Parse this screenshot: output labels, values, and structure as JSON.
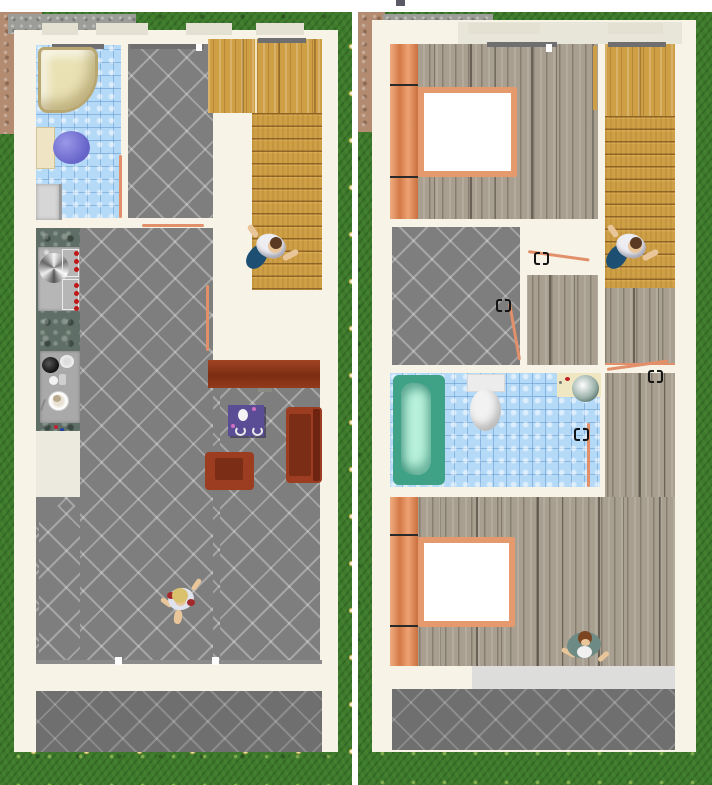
{
  "scene": {
    "type": "home-design-aerial-3d-view",
    "description": "Two top-down rendered views of the same house: ground floor (left) and upper floor (right), lawn with daisies around, dirt path and concrete walk at top-left of each view",
    "panels": [
      {
        "name": "ground-floor-view",
        "side": "left",
        "rooms": [
          {
            "name": "bathroom",
            "floor_texture": "blue-tile",
            "items": [
              "corner-shower",
              "toilet",
              "washing-machine"
            ]
          },
          {
            "name": "entry-hall",
            "floor_texture": "gray-diagonal-tile"
          },
          {
            "name": "staircase",
            "floor_texture": "golden-wood",
            "items": [
              "landing",
              "stair-treads"
            ]
          },
          {
            "name": "kitchen",
            "counter_texture": "green-stone",
            "items": [
              "sink-stove-unit-with-red-knobs",
              "prep-counter-with-pots-and-plates",
              "base-cabinet"
            ]
          },
          {
            "name": "living-room",
            "floor_texture": "gray-diagonal-tile",
            "items": [
              "sideboard-table",
              "purple-coffee-table",
              "armchair",
              "sofa"
            ]
          },
          {
            "name": "terrace",
            "floor_texture": "gray-diagonal-tile"
          }
        ],
        "open_doors": [
          "bathroom-door",
          "hall-to-living-door",
          "living-to-stairs-door"
        ]
      },
      {
        "name": "upper-floor-view",
        "side": "right",
        "rooms": [
          {
            "name": "bedroom-north",
            "floor_texture": "weathered-gray-wood",
            "items": [
              "wardrobe-row",
              "double-bed"
            ]
          },
          {
            "name": "staircase",
            "floor_texture": "golden-wood",
            "items": [
              "landing",
              "stair-treads"
            ]
          },
          {
            "name": "den",
            "floor_texture": "gray-diagonal-tile"
          },
          {
            "name": "hallway",
            "floor_texture": "weathered-gray-wood"
          },
          {
            "name": "bathroom",
            "floor_texture": "blue-tile",
            "items": [
              "bathtub",
              "toilet",
              "vanity-sink"
            ]
          },
          {
            "name": "bedroom-south",
            "floor_texture": "weathered-gray-wood",
            "items": [
              "wardrobe-row",
              "double-bed"
            ]
          },
          {
            "name": "balcony",
            "floor_texture": "light-concrete"
          },
          {
            "name": "terrace-below",
            "floor_texture": "gray-diagonal-tile"
          }
        ],
        "open_doors": [
          "bedroom-north-door",
          "den-door",
          "hallway-door",
          "bathroom-door"
        ]
      }
    ],
    "people": [
      {
        "name": "man-on-stairs-ground-floor",
        "hair": "#5a3a22",
        "top": "#ededf2",
        "bottom": "#1d4f73",
        "skin": "#e9c59a"
      },
      {
        "name": "blonde-person-walking-living-room",
        "hair": "#d9c16e",
        "top": "#dfe3ee",
        "accent": "#a32a2a",
        "skin": "#e9c59a"
      },
      {
        "name": "man-on-stairs-upper-floor",
        "hair": "#5a3a22",
        "top": "#ededf2",
        "bottom": "#1d4f73",
        "skin": "#e9c59a"
      },
      {
        "name": "man-in-south-bedroom",
        "hair": "#7a4520",
        "top": "#6e8a84",
        "shirt": "#f0f0f0",
        "skin": "#e9c59a"
      }
    ],
    "colors": {
      "grass": "#3d7a2c",
      "dirt_path": "#b28b71",
      "sidewalk": "#9c9c98",
      "wall": "#f7f3e7",
      "window_gap": "#e4e0d2",
      "lintel": "#6f6f6f",
      "tile_gray": "#7e7e7e",
      "tile_terrace": "#6f6f6f",
      "tile_blue": "#b5daf8",
      "wood_golden": "#cf9f45",
      "wood_weathered": "#a89f90",
      "stone_counter": "#5f6e66",
      "door_open": "#e2906a",
      "shower": "#e9e1b4",
      "toilet_lid_purple": "#7b79d9",
      "toilet_tank": "#efe5c4",
      "toilet_white": "#f2f2f2",
      "washer": "#d6d6d6",
      "cabinet": "#eceade",
      "sideboard": "#8e3b1e",
      "coffee_table": "#5a4d96",
      "sofa": "#9c3c20",
      "armchair": "#9c3c20",
      "seat_inner": "#7c2d15",
      "wardrobe": "#de8d60",
      "bed_frame": "#e59a6e",
      "mattress": "#ffffff",
      "bathtub_rim": "#3fa287",
      "bathtub_inner": "#b9f2dd",
      "sink_counter": "#efe7c2",
      "balcony": "#dddddb",
      "knob_red": "#c01818",
      "top_marker": "#5a5a66"
    }
  }
}
